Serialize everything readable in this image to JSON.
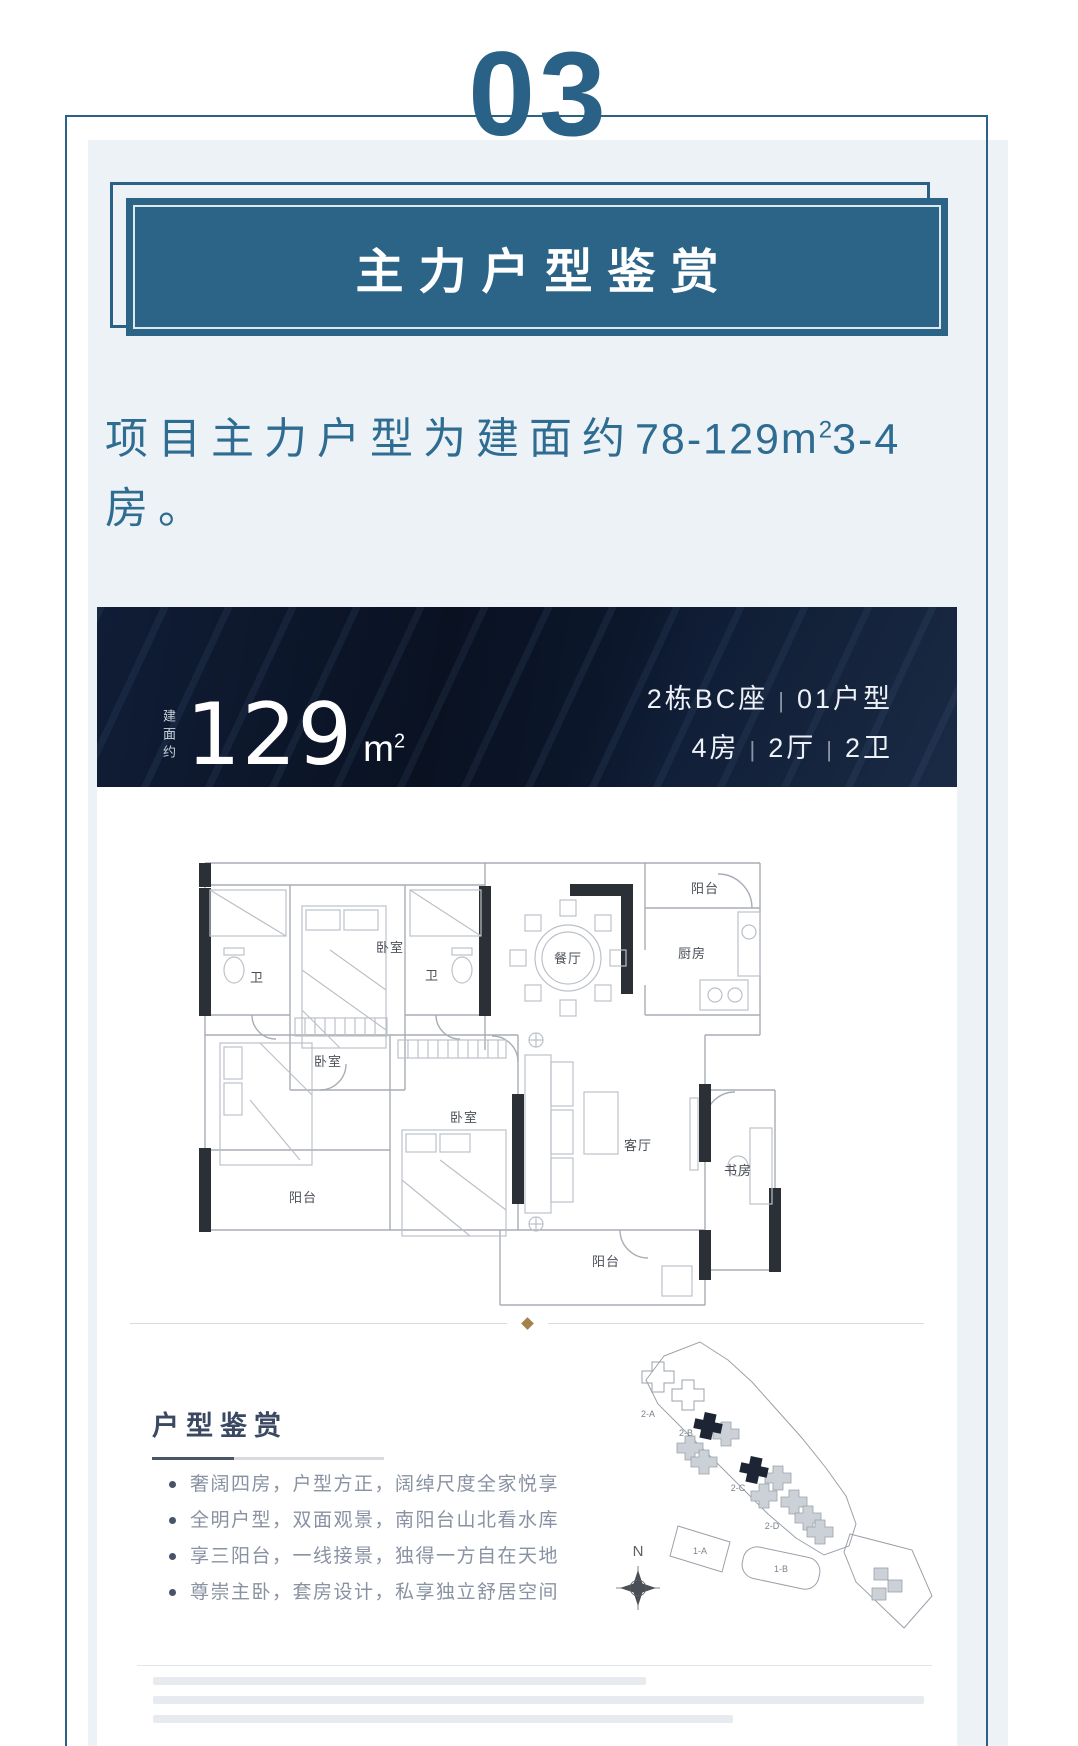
{
  "page": {
    "section_number": "03",
    "banner_title": "主力户型鉴赏",
    "intro": {
      "line1_text": "项目主力户型为建面约",
      "range": "78-129",
      "unit_base": "m",
      "unit_exponent": "2",
      "line1_tail": "3-4",
      "line2_text": "房。"
    },
    "unit_header": {
      "area_label_vertical": "建面约",
      "area_value": "129",
      "area_unit_base": "m",
      "area_unit_exponent": "2",
      "block_label": "2栋BC座",
      "separator": "|",
      "unit_label": "01户型",
      "layout_parts": [
        "4房",
        "2厅",
        "2卫"
      ]
    },
    "floor_plan_rooms": {
      "bath1": "卫",
      "bedroom_top": "卧室",
      "bath2": "卫",
      "dining": "餐厅",
      "balcony_tr": "阳台",
      "kitchen": "厨房",
      "bedroom_left": "卧室",
      "bedroom_mid": "卧室",
      "living": "客厅",
      "study": "书房",
      "balcony_bl": "阳台",
      "balcony_bc": "阳台"
    },
    "appreciation": {
      "heading": "户型鉴赏",
      "bullets": [
        "奢阔四房，户型方正，阔绰尺度全家悦享",
        "全明户型，双面观景，南阳台山北看水库",
        "享三阳台，一线接景，独得一方自在天地",
        "尊崇主卧，套房设计，私享独立舒居空间"
      ]
    },
    "site_map": {
      "labels": {
        "b2a": "2-A",
        "b2b": "2-B",
        "b2c": "2-C",
        "b2d": "2-D",
        "b1a": "1-A",
        "b1b": "1-B"
      },
      "compass": "N"
    },
    "disclaimer": {
      "lines": 3,
      "legible": false
    }
  },
  "colors": {
    "accent_blue": "#2a6186",
    "banner_blue": "#2c6488",
    "panel_gray_blue": "#edf2f7",
    "dark_navy": "#0a1322",
    "bronze_diamond": "#a5814e",
    "intro_text": "#2e6c92"
  }
}
